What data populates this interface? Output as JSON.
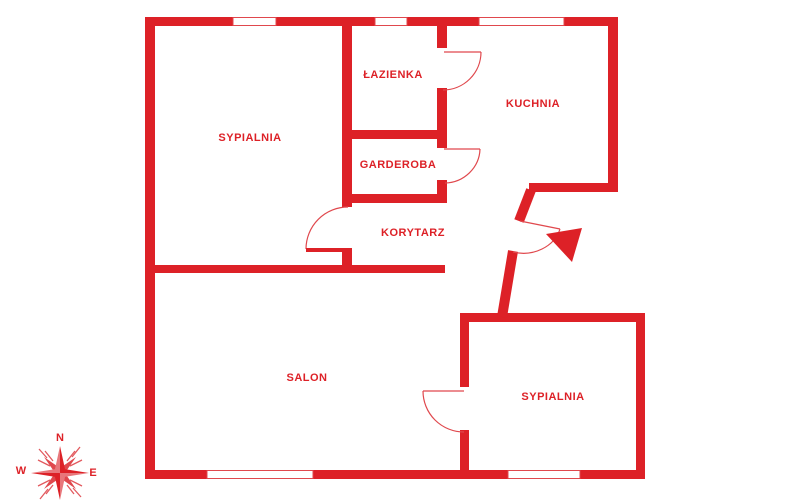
{
  "plan": {
    "type": "apartment-floor-plan",
    "colors": {
      "wall_red": "#dd2127",
      "thin_red": "#e0484d",
      "background": "#ffffff"
    },
    "rooms": [
      {
        "id": "sypialnia-1",
        "label": "SYPIALNIA"
      },
      {
        "id": "lazienka",
        "label": "ŁAZIENKA"
      },
      {
        "id": "garderoba",
        "label": "GARDEROBA"
      },
      {
        "id": "korytarz",
        "label": "KORYTARZ"
      },
      {
        "id": "kuchnia",
        "label": "KUCHNIA"
      },
      {
        "id": "salon",
        "label": "SALON"
      },
      {
        "id": "sypialnia-2",
        "label": "SYPIALNIA"
      }
    ],
    "compass": {
      "north": "N",
      "west": "W",
      "east": "E"
    }
  }
}
